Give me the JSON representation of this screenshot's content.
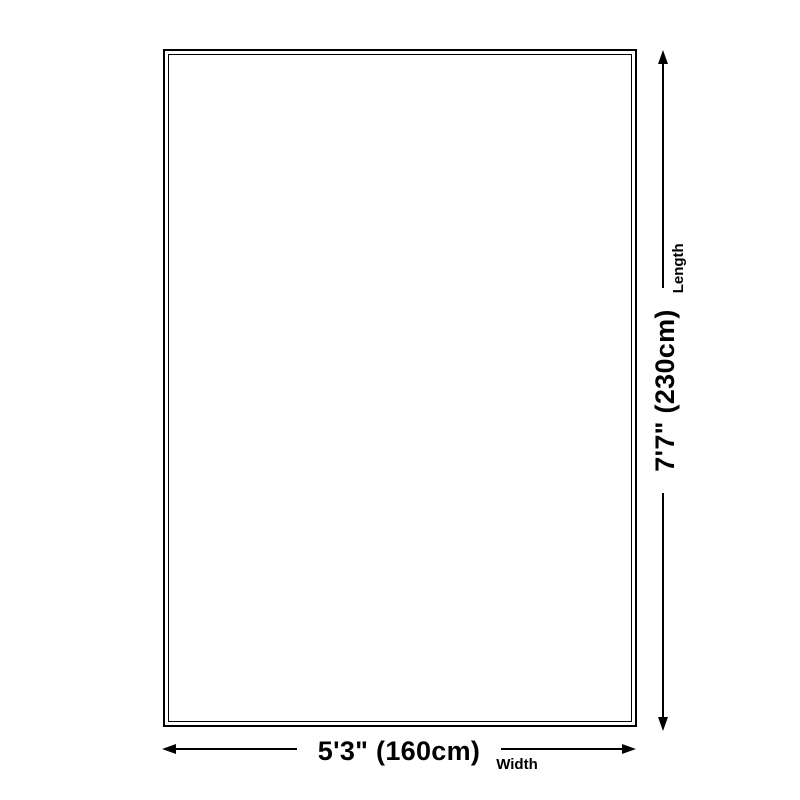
{
  "diagram": {
    "title": "rug-size-diagram",
    "width": {
      "value": "5'3\" (160cm)",
      "label": "Width"
    },
    "length": {
      "value": "7'7\" (230cm)",
      "label": "Length"
    }
  },
  "icons": {
    "arrow-left": "left-pointing filled triangle",
    "arrow-right": "right-pointing filled triangle",
    "arrow-up": "up-pointing filled triangle",
    "arrow-down": "down-pointing filled triangle"
  },
  "colors": {
    "line": "#000000",
    "text": "#000000",
    "background": "#ffffff"
  }
}
